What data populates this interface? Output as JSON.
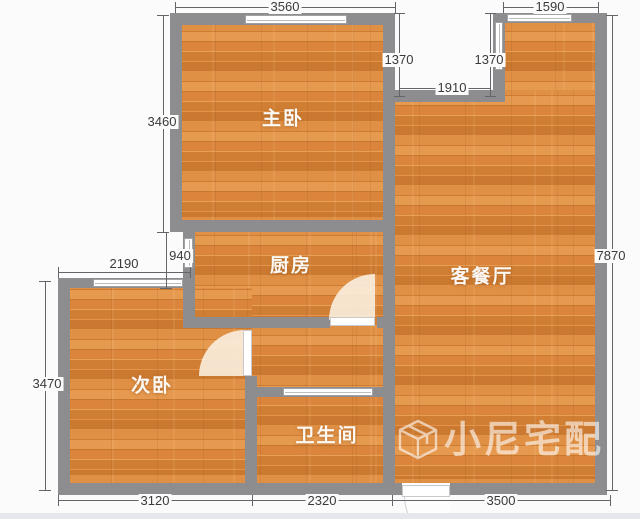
{
  "plan": {
    "watermark": "小尼宅配",
    "rooms": {
      "master": {
        "label": "主卧"
      },
      "kitchen": {
        "label": "厨房"
      },
      "living": {
        "label": "客餐厅"
      },
      "second": {
        "label": "次卧"
      },
      "bathroom": {
        "label": "卫生间"
      }
    },
    "dims": {
      "master_top": "3560",
      "living_top": "1590",
      "notch_left_h": "1370",
      "notch_right_h": "1370",
      "notch_w": "1910",
      "master_left_h": "3460",
      "kitchen_offset": "940",
      "second_top_w": "2190",
      "living_right_h": "7870",
      "second_left_h": "3470",
      "bottom_left": "3120",
      "bottom_mid": "2320",
      "bottom_right": "3500"
    },
    "colors": {
      "wall": "#8d8d8f",
      "floor": "#dd8a3d",
      "dim_text": "#3a3a3b"
    }
  }
}
